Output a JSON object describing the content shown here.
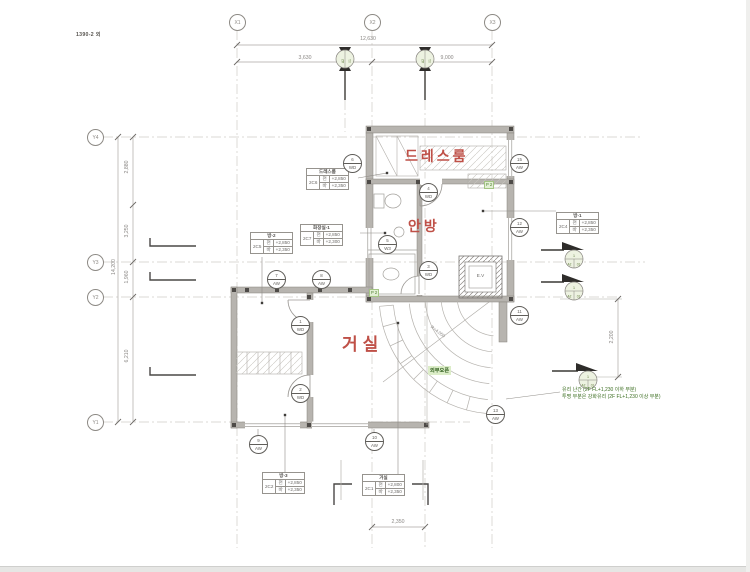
{
  "title": "1390-2 외",
  "grid": {
    "x": [
      "X1",
      "X2",
      "X3"
    ],
    "y": [
      "Y4",
      "Y3",
      "Y2",
      "Y1"
    ]
  },
  "dims": {
    "top_total": "12,630",
    "top_seg_left": "3,630",
    "top_seg_right": "9,000",
    "left_total": "14,200",
    "left_seg_1": "2,880",
    "left_seg_2": "3,250",
    "left_seg_3": "1,960",
    "left_seg_4": "6,210",
    "right_seg": "2,200",
    "bottom_seg": "2,350",
    "stair_radius": "R=4,050"
  },
  "rooms": {
    "dressroom": "드레스룸",
    "master_bedroom": "안방",
    "living_room": "거실"
  },
  "room_tags": [
    {
      "name": "드레스룸",
      "code": "2C6",
      "rows": [
        [
          "천",
          "+2,850"
        ],
        [
          "바",
          "+2,350"
        ]
      ]
    },
    {
      "name": "화장실-1",
      "code": "2C7",
      "rows": [
        [
          "천",
          "+2,850"
        ],
        [
          "바",
          "+2,300"
        ]
      ]
    },
    {
      "name": "방-2",
      "code": "2C5",
      "rows": [
        [
          "천",
          "+2,850"
        ],
        [
          "바",
          "+2,350"
        ]
      ]
    },
    {
      "name": "방-1",
      "code": "2C4",
      "rows": [
        [
          "천",
          "+2,850"
        ],
        [
          "바",
          "+2,350"
        ]
      ]
    },
    {
      "name": "방-3",
      "code": "2C2",
      "rows": [
        [
          "천",
          "+2,850"
        ],
        [
          "바",
          "+2,350"
        ]
      ]
    },
    {
      "name": "거실",
      "code": "2C1",
      "rows": [
        [
          "천",
          "+2,800"
        ],
        [
          "바",
          "+2,350"
        ]
      ]
    }
  ],
  "opening_tags": [
    {
      "num": "6",
      "type": "WD"
    },
    {
      "num": "4",
      "type": "WD"
    },
    {
      "num": "5",
      "type": "W3"
    },
    {
      "num": "3",
      "type": "WD"
    },
    {
      "num": "15",
      "type": "AW"
    },
    {
      "num": "12",
      "type": "AW"
    },
    {
      "num": "11",
      "type": "AW"
    },
    {
      "num": "7",
      "type": "AW"
    },
    {
      "num": "8",
      "type": "AW"
    },
    {
      "num": "1",
      "type": "WD"
    },
    {
      "num": "2",
      "type": "WD"
    },
    {
      "num": "9",
      "type": "AW"
    },
    {
      "num": "10",
      "type": "AW"
    },
    {
      "num": "13",
      "type": "AW"
    }
  ],
  "markers": {
    "top": "1",
    "sheet": "A2",
    "num": "01"
  },
  "labels": {
    "exterior_open": "외부오픈",
    "note_line1": "유리 난간 (2F FL+1,230 이하 부분)",
    "note_line2": "투명 부분은 강화유리 (2F FL+1,230 이상 부분)",
    "elevator": "E.V",
    "column": "P 2"
  },
  "colors": {
    "room_label": "#bf5047",
    "annotation_green": "#3c6e21",
    "wall_gray": "#b7b4af"
  }
}
